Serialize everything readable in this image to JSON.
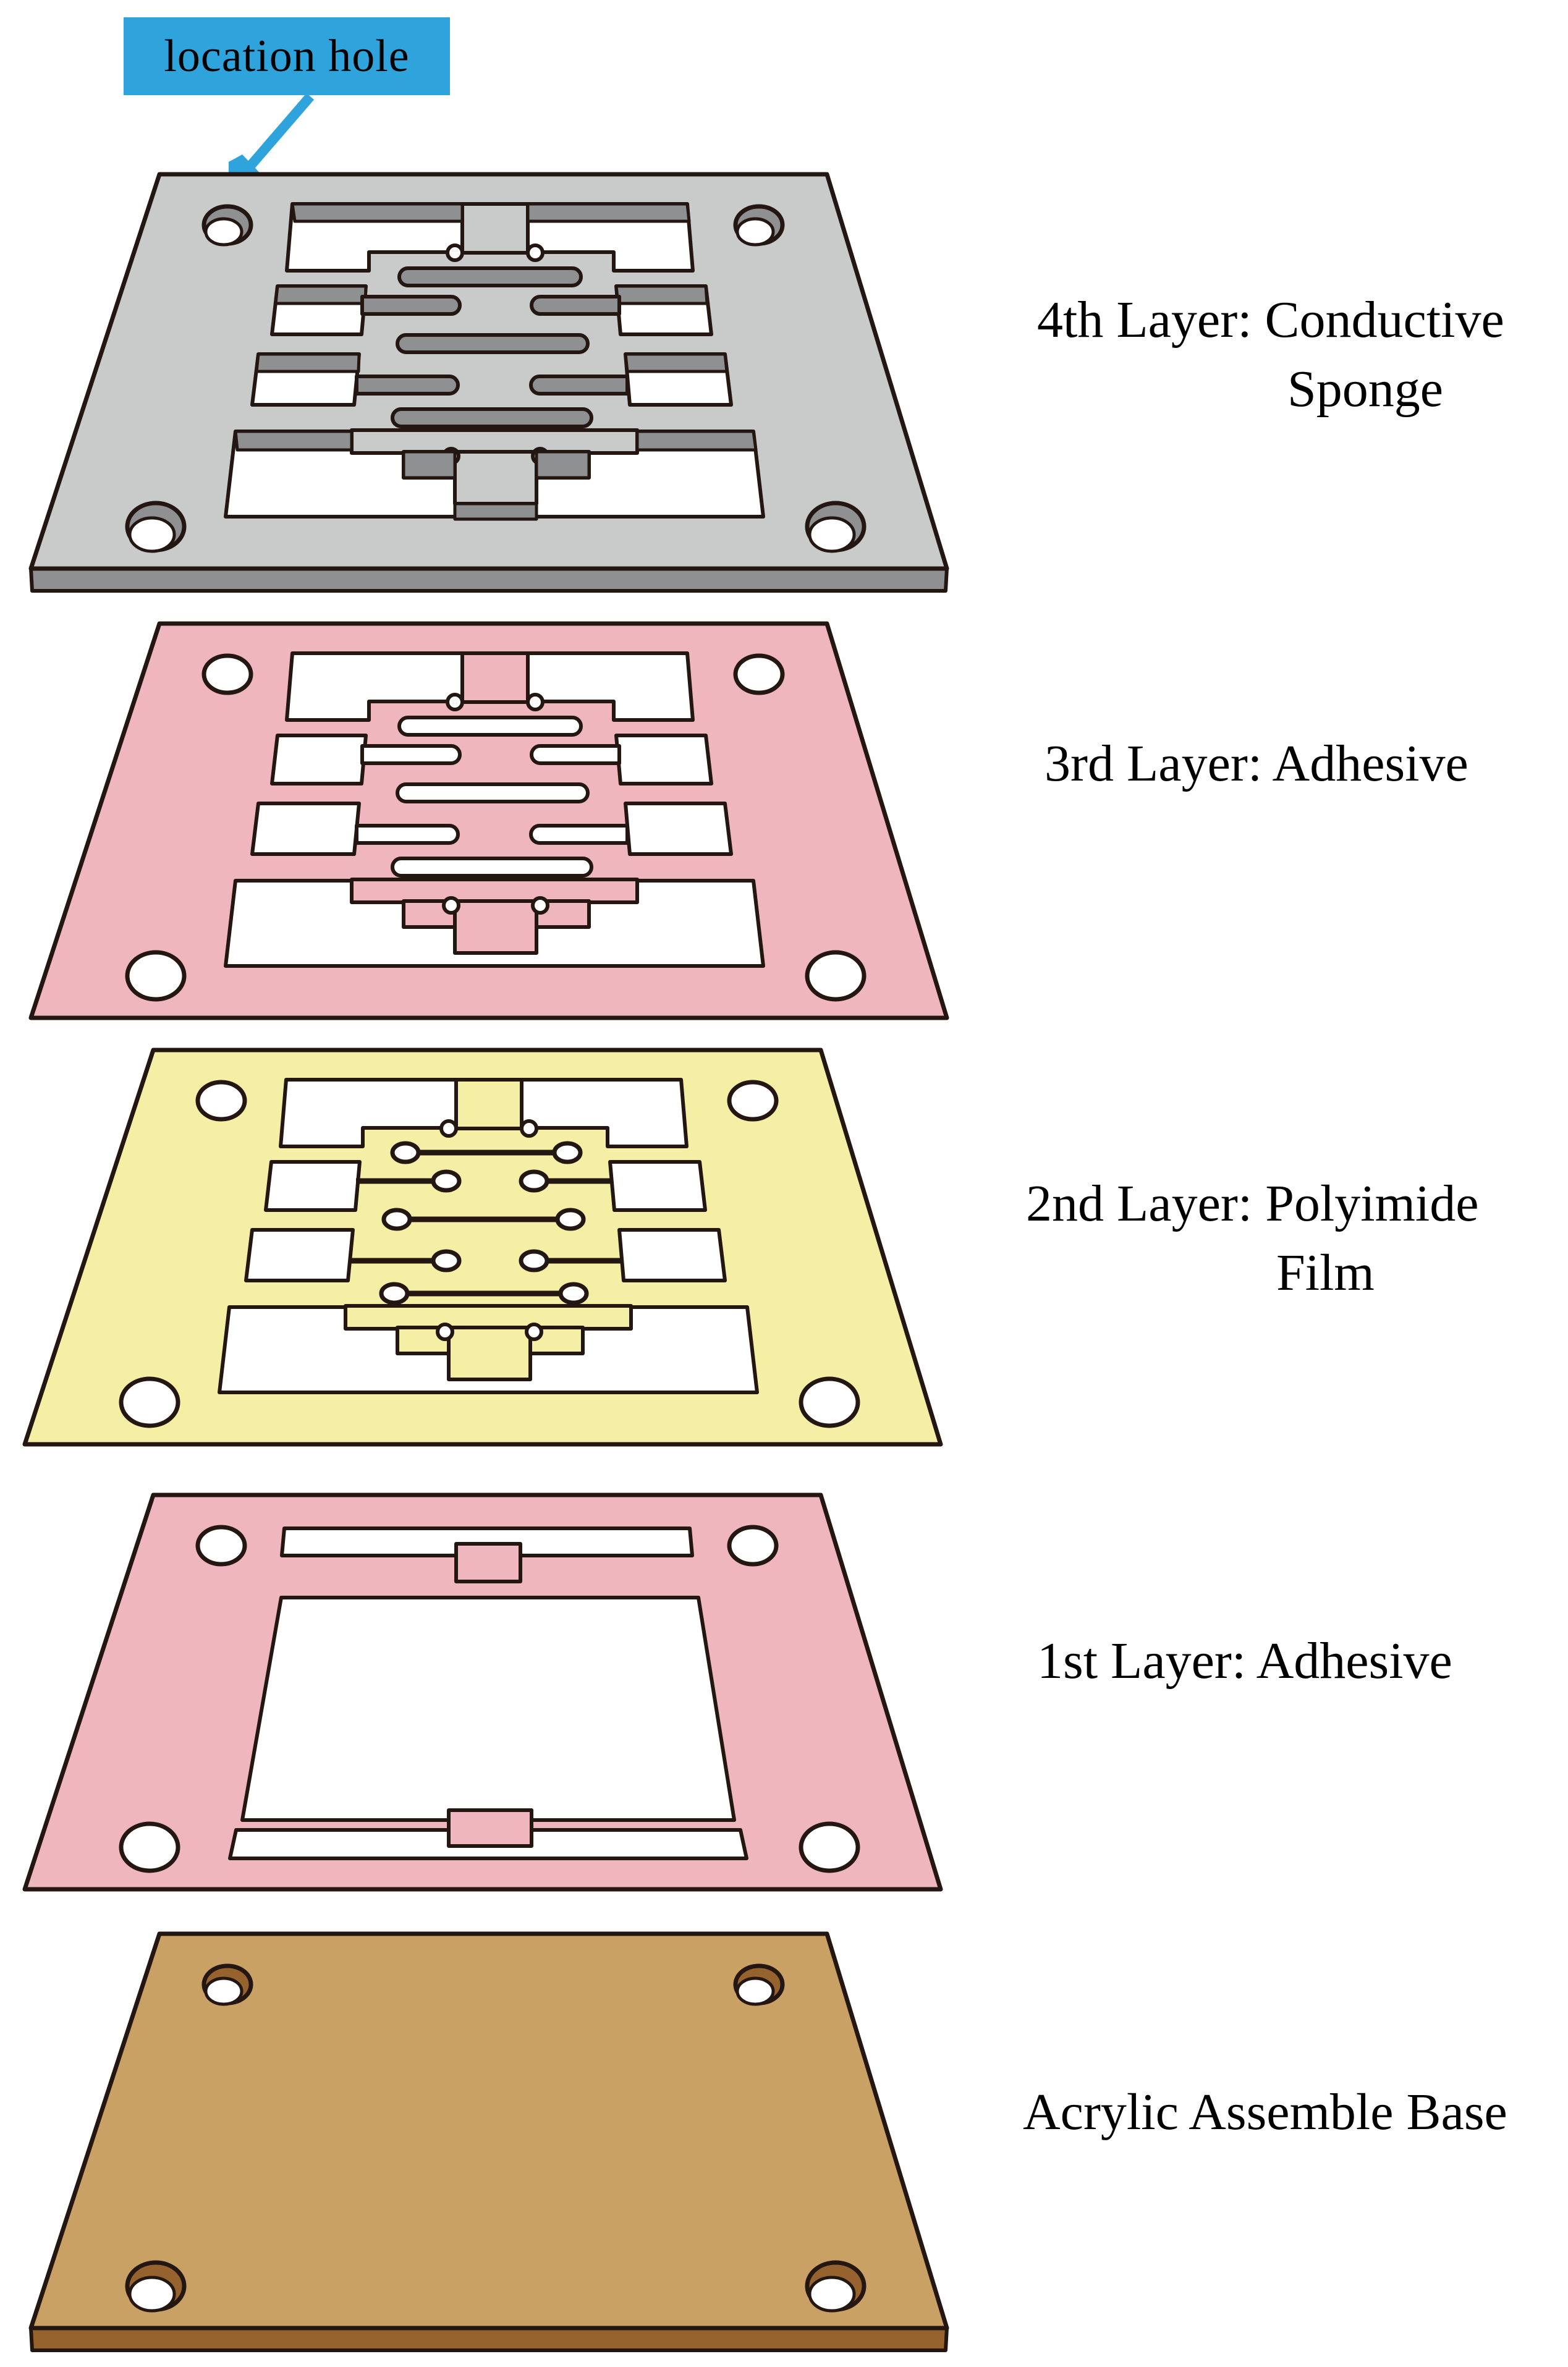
{
  "callout": {
    "text": "location hole"
  },
  "layers": [
    {
      "name": "conductive-sponge",
      "label_line1": "4th Layer: Conductive",
      "label_line2": "Sponge",
      "color": "#C9CACA",
      "side_color": "#8F9091"
    },
    {
      "name": "adhesive-3rd",
      "label_line1": "3rd Layer: Adhesive",
      "label_line2": "",
      "color": "#EFB6BE"
    },
    {
      "name": "polyimide-film",
      "label_line1": "2nd Layer: Polyimide",
      "label_line2": "Film",
      "color": "#F4EFA5"
    },
    {
      "name": "adhesive-1st",
      "label_line1": "1st Layer: Adhesive",
      "label_line2": "",
      "color": "#EFB6BE"
    },
    {
      "name": "acrylic-base",
      "label_line1": "Acrylic Assemble Base",
      "label_line2": "",
      "color": "#C9A165",
      "side_color": "#96632F"
    }
  ],
  "icons": {
    "callout_arrow": "down-left-arrow-icon"
  },
  "colors": {
    "blue": "#2EA3DC",
    "ink": "#241712",
    "gray": "#C9CACA",
    "grayside": "#8F9091",
    "pink": "#EFB6BE",
    "yellow": "#F4EFA5",
    "brown": "#C9A165",
    "brownside": "#96632F"
  }
}
